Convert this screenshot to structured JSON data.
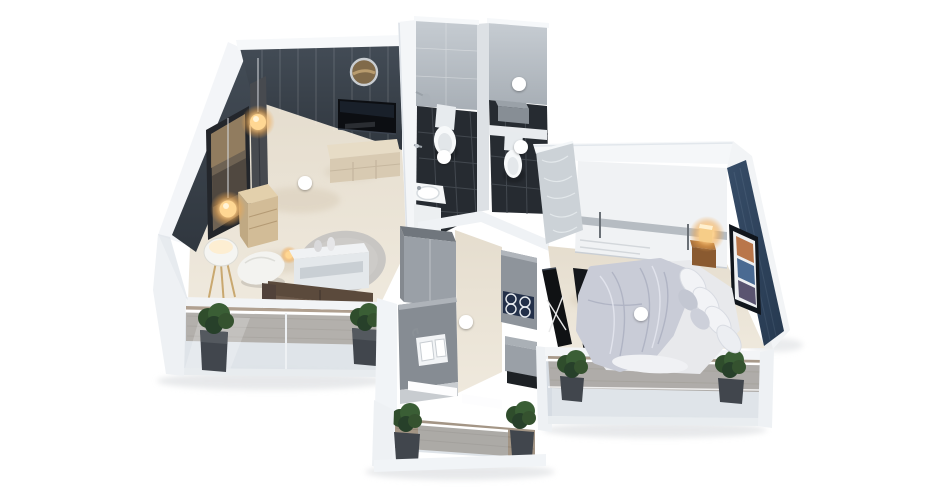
{
  "meta": {
    "alt_text": "3D isometric architectural render of a one-bedroom apartment floor plan: living room with dark accent wall and TV, two bathrooms with dark tiled floors, kitchen with parallel counters, bedroom with navy accent wall and double bed, and three balconies with potted plants and glass railings. White dot callout markers with leader lines point at each room.",
    "render_style": "isometric-3d-floorplan",
    "background": "#ffffff"
  },
  "palette": {
    "background": "#ffffff",
    "wall_white": "#f3f5f8",
    "wall_shade": "#dde2e8",
    "accent_wall_dark": "#39424c",
    "accent_wall_navy": "#2e425c",
    "floor_marble": "#eae3d6",
    "floor_tile_dark": "#272c33",
    "balcony_wood": "#ab9d8d",
    "cabinet_gray": "#9aa0a7",
    "counter_gray": "#868c93",
    "wood_light": "#d7c5a4",
    "wood_warm": "#96642f",
    "sofa_brown": "#5d4c3f",
    "plant_green": "#35522f",
    "planter_gray": "#41464d",
    "glass_tint": "#b9c4ce",
    "cooktop_navy": "#233049",
    "glow_warm": "#ffc46a",
    "hotspot_color": "#ffffff"
  },
  "hotspots": [
    {
      "name": "living-room-hotspot",
      "room": "living-room",
      "dot": {
        "x": 305,
        "y": 183,
        "r": 7
      },
      "line": {
        "x1": 305,
        "y1": 24,
        "x2": 305,
        "y2": 176
      }
    },
    {
      "name": "bathroom-hotspot",
      "room": "bathroom",
      "dot": {
        "x": 444,
        "y": 157,
        "r": 7
      },
      "line": {
        "x1": 444,
        "y1": 18,
        "x2": 444,
        "y2": 150
      }
    },
    {
      "name": "wc-upper-hotspot",
      "room": "wc-upper",
      "dot": {
        "x": 519,
        "y": 84,
        "r": 7
      },
      "line": {
        "x1": 519,
        "y1": 18,
        "x2": 519,
        "y2": 77
      }
    },
    {
      "name": "wc-lower-hotspot",
      "room": "wc-lower",
      "dot": {
        "x": 521,
        "y": 147,
        "r": 7
      },
      "line": {
        "x1": 528,
        "y1": 147,
        "x2": 598,
        "y2": 147
      }
    },
    {
      "name": "kitchen-hotspot",
      "room": "kitchen",
      "dot": {
        "x": 466,
        "y": 322,
        "r": 7
      },
      "line": {
        "x1": 466,
        "y1": 329,
        "x2": 466,
        "y2": 465
      }
    },
    {
      "name": "bedroom-hotspot",
      "room": "bedroom",
      "dot": {
        "x": 641,
        "y": 314,
        "r": 7
      },
      "line": {
        "x1": 641,
        "y1": 321,
        "x2": 641,
        "y2": 424
      }
    }
  ]
}
